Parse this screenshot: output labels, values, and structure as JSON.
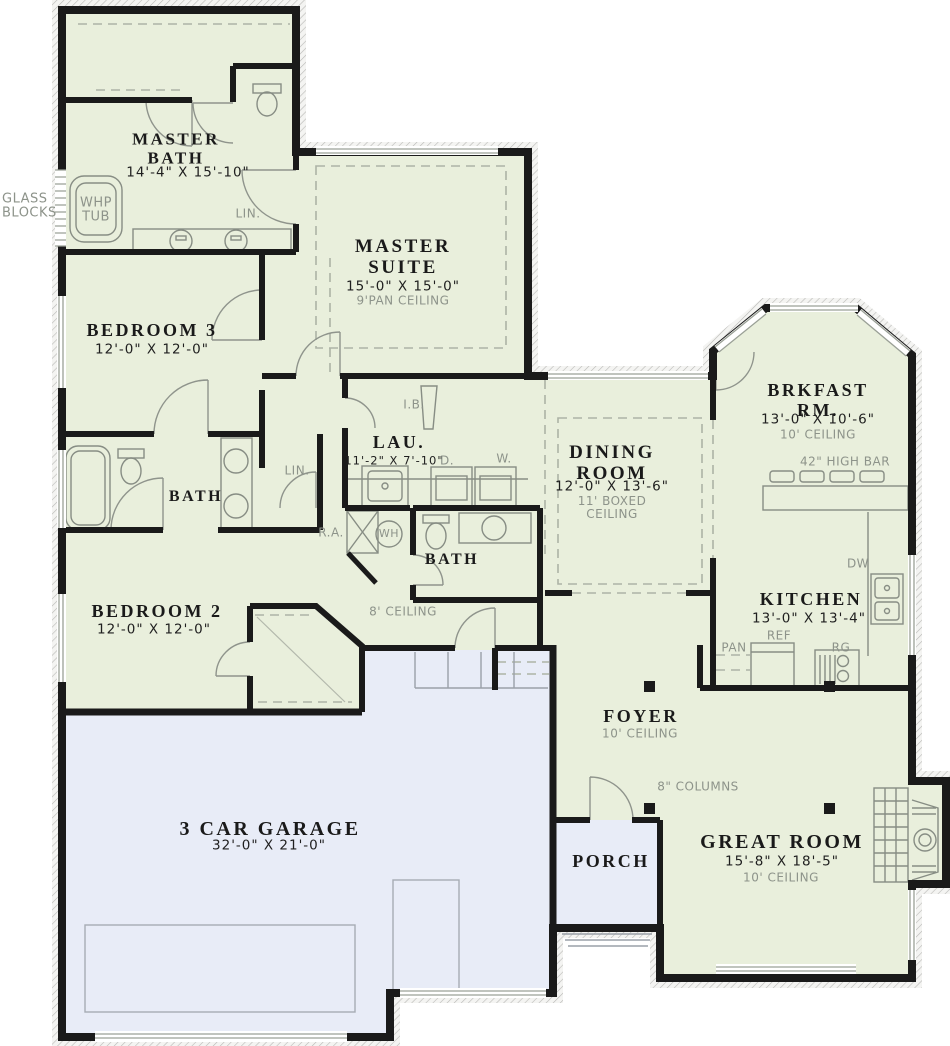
{
  "rooms": {
    "master_bath": {
      "title": "MASTER\nBATH",
      "dims": "14'-4\" X 15'-10\""
    },
    "master_suite": {
      "title": "MASTER\nSUITE",
      "dims": "15'-0\" X 15'-0\"",
      "note": "9'PAN CEILING"
    },
    "bedroom3": {
      "title": "BEDROOM 3",
      "dims": "12'-0\" X 12'-0\""
    },
    "hall_bath": {
      "title": "BATH"
    },
    "laundry": {
      "title": "LAU.",
      "dims": "11'-2\" X 7'-10\""
    },
    "bath2": {
      "title": "BATH"
    },
    "dining": {
      "title": "DINING\nROOM",
      "dims": "12'-0\" X 13'-6\"",
      "note": "11' BOXED\nCEILING"
    },
    "breakfast": {
      "title": "BRKFAST RM.",
      "dims": "13'-0\" X 10'-6\"",
      "note": "10' CEILING"
    },
    "kitchen": {
      "title": "KITCHEN",
      "dims": "13'-0\" X 13'-4\""
    },
    "foyer": {
      "title": "FOYER",
      "note": "10' CEILING"
    },
    "great_room": {
      "title": "GREAT ROOM",
      "dims": "15'-8\" X 18'-5\"",
      "note": "10' CEILING"
    },
    "porch": {
      "title": "PORCH"
    },
    "bedroom2": {
      "title": "BEDROOM 2",
      "dims": "12'-0\" X 12'-0\""
    },
    "garage": {
      "title": "3 CAR GARAGE",
      "dims": "32'-0\" X 21'-0\""
    }
  },
  "labels": {
    "glass_blocks": "GLASS\nBLOCKS",
    "whp_tub": "WHP\nTUB",
    "lin_master": "LIN.",
    "lin_hall": "LIN.",
    "ironing_board": "I.B.",
    "dryer": "D.",
    "washer": "W.",
    "return_air": "R.A.",
    "water_heater": "WH",
    "high_bar": "42\" HIGH BAR",
    "dishwasher": "DW",
    "refrigerator": "REF",
    "pantry": "PAN",
    "range": "RG",
    "columns": "8\" COLUMNS",
    "hall_ceiling": "8' CEILING"
  },
  "colors": {
    "floor_green": "#e9efdc",
    "floor_blue": "#e8ecf7",
    "wall": "#1a1a1a",
    "note_gray": "#8d938a"
  }
}
